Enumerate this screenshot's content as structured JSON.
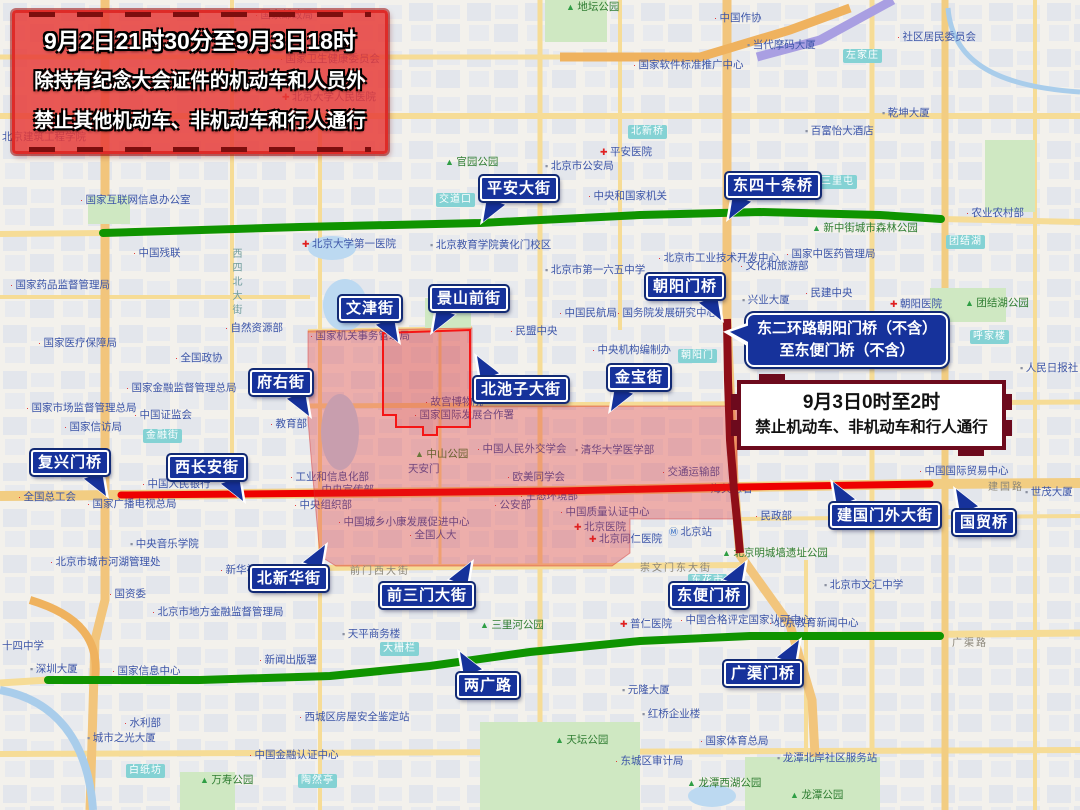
{
  "banners": {
    "top_left": {
      "line1": "9月2日21时30分至9月3日18时",
      "line2": "除持有纪念大会证件的机动车和人员外",
      "line3": "禁止其他机动车、非机动车和行人通行"
    },
    "east_ring": {
      "line1": "东二环路朝阳门桥（不含）",
      "line2": "至东便门桥（不含）"
    },
    "night_ban": {
      "line1": "9月3日0时至2时",
      "line2": "禁止机动车、非机动车和行人通行"
    }
  },
  "street_labels": [
    {
      "id": "pingan-dajie",
      "text": "平安大街",
      "x": 480,
      "y": 176,
      "tail": "bl"
    },
    {
      "id": "dongsishitiao-qiao",
      "text": "东四十条桥",
      "x": 726,
      "y": 173,
      "tail": "bl"
    },
    {
      "id": "wenjin-jie",
      "text": "文津街",
      "x": 339,
      "y": 296,
      "tail": "br"
    },
    {
      "id": "jingshanqian-jie",
      "text": "景山前街",
      "x": 430,
      "y": 286,
      "tail": "bl"
    },
    {
      "id": "chaoyangmen-qiao",
      "text": "朝阳门桥",
      "x": 646,
      "y": 274,
      "tail": "br"
    },
    {
      "id": "fuyou-jie",
      "text": "府右街",
      "x": 250,
      "y": 370,
      "tail": "br"
    },
    {
      "id": "beichizi-dajie",
      "text": "北池子大街",
      "x": 474,
      "y": 377,
      "tail": "tl"
    },
    {
      "id": "jinbao-jie",
      "text": "金宝街",
      "x": 608,
      "y": 365,
      "tail": "bl"
    },
    {
      "id": "fuxingmen-qiao",
      "text": "复兴门桥",
      "x": 31,
      "y": 450,
      "tail": "br"
    },
    {
      "id": "xichangan-jie",
      "text": "西长安街",
      "x": 168,
      "y": 455,
      "tail": "br"
    },
    {
      "id": "beixinhua-jie",
      "text": "北新华街",
      "x": 250,
      "y": 566,
      "tail": "tr"
    },
    {
      "id": "qiansanmen-dajie",
      "text": "前三门大街",
      "x": 380,
      "y": 583,
      "tail": "tr"
    },
    {
      "id": "dongbianmen-qiao",
      "text": "东便门桥",
      "x": 670,
      "y": 583,
      "tail": "tr"
    },
    {
      "id": "liangguang-lu",
      "text": "两广路",
      "x": 457,
      "y": 673,
      "tail": "tl"
    },
    {
      "id": "jianguomenwai-dajie",
      "text": "建国门外大街",
      "x": 830,
      "y": 503,
      "tail": "tl"
    },
    {
      "id": "guomao-qiao",
      "text": "国贸桥",
      "x": 953,
      "y": 510,
      "tail": "tl"
    },
    {
      "id": "guangqumen-qiao",
      "text": "广渠门桥",
      "x": 724,
      "y": 661,
      "tail": "tr"
    }
  ],
  "overlays": {
    "colors": {
      "restricted_green": "#0f9400",
      "restricted_red": "#ee0000",
      "restricted_maroon": "#8e0e18",
      "zone_fill": "rgba(224,40,40,0.33)",
      "label_navy": "#16329b"
    },
    "green_line_north": "103,233 300,227 480,223 640,215 760,212 880,215 941,219",
    "green_line_south": "48,680 200,680 330,676 430,666 530,652 640,641 750,636 940,636",
    "red_line": "121,495 350,493 560,491 740,487 930,484",
    "maroon_line": "727,319 728,380 730,440 734,490 737,520 740,553",
    "zone_polygon": "308,331 472,328 472,406 737,406 737,519 630,519 630,553 612,566 336,566 320,556 312,468 308,420",
    "inner_outline": "383,333 470,330 470,427 437,427 437,435 423,435 423,427 396,427 396,415 383,415"
  },
  "map": {
    "badges": [
      {
        "text": "交道口",
        "x": 436,
        "y": 193
      },
      {
        "text": "北新桥",
        "x": 628,
        "y": 125
      },
      {
        "text": "左家庄",
        "x": 843,
        "y": 49
      },
      {
        "text": "三里屯",
        "x": 818,
        "y": 175
      },
      {
        "text": "团结湖",
        "x": 946,
        "y": 235
      },
      {
        "text": "呼家楼",
        "x": 970,
        "y": 330
      },
      {
        "text": "朝阳门",
        "x": 678,
        "y": 349
      },
      {
        "text": "金融街",
        "x": 143,
        "y": 429
      },
      {
        "text": "大栅栏",
        "x": 380,
        "y": 642
      },
      {
        "text": "东花市",
        "x": 688,
        "y": 574
      },
      {
        "text": "白纸坊",
        "x": 126,
        "y": 764
      },
      {
        "text": "陶然亭",
        "x": 298,
        "y": 774
      }
    ],
    "street_names": [
      {
        "text": "西四北大街",
        "x": 228,
        "y": 248,
        "vert": true
      },
      {
        "text": "前门西大街",
        "x": 350,
        "y": 562,
        "vert": false
      },
      {
        "text": "崇文门东大街",
        "x": 640,
        "y": 559,
        "vert": false
      },
      {
        "text": "广渠路",
        "x": 952,
        "y": 634,
        "vert": false
      },
      {
        "text": "建国路",
        "x": 988,
        "y": 478,
        "vert": false
      }
    ],
    "pois": [
      {
        "t": "国家邮政局",
        "x": 255,
        "y": 18,
        "k": "dot"
      },
      {
        "t": "北京汉华国际饭店",
        "x": 228,
        "y": 48,
        "k": "bld"
      },
      {
        "t": "国家卫生健康委员会",
        "x": 280,
        "y": 62,
        "k": "dot"
      },
      {
        "t": "北京大学人民医院",
        "x": 282,
        "y": 100,
        "k": "hosp"
      },
      {
        "t": "社区居民委员会",
        "x": 897,
        "y": 40,
        "k": "dot"
      },
      {
        "t": "中国作协",
        "x": 714,
        "y": 21,
        "k": "dot"
      },
      {
        "t": "当代摩码大厦",
        "x": 747,
        "y": 48,
        "k": "bld"
      },
      {
        "t": "地坛公园",
        "x": 566,
        "y": 10,
        "k": "park"
      },
      {
        "t": "国家软件标准推广中心",
        "x": 633,
        "y": 68,
        "k": "dot"
      },
      {
        "t": "乾坤大厦",
        "x": 882,
        "y": 116,
        "k": "bld"
      },
      {
        "t": "百富怡大酒店",
        "x": 805,
        "y": 134,
        "k": "bld"
      },
      {
        "t": "北京建筑工程学院",
        "x": 2,
        "y": 140,
        "k": "none"
      },
      {
        "t": "官园公园",
        "x": 445,
        "y": 165,
        "k": "park"
      },
      {
        "t": "平安医院",
        "x": 600,
        "y": 155,
        "k": "hosp"
      },
      {
        "t": "中央和国家机关",
        "x": 588,
        "y": 199,
        "k": "dot"
      },
      {
        "t": "国家互联网信息办公室",
        "x": 80,
        "y": 203,
        "k": "dot"
      },
      {
        "t": "北京市公安局",
        "x": 545,
        "y": 169,
        "k": "bld"
      },
      {
        "t": "中国残联",
        "x": 133,
        "y": 256,
        "k": "dot"
      },
      {
        "t": "北京大学第一医院",
        "x": 302,
        "y": 247,
        "k": "hosp"
      },
      {
        "t": "国家药品监督管理局",
        "x": 10,
        "y": 288,
        "k": "dot"
      },
      {
        "t": "北京教育学院黄化门校区",
        "x": 430,
        "y": 248,
        "k": "bld"
      },
      {
        "t": "北京市第一六五中学",
        "x": 545,
        "y": 273,
        "k": "bld"
      },
      {
        "t": "北京市工业技术开发中心",
        "x": 658,
        "y": 261,
        "k": "dot"
      },
      {
        "t": "文化和旅游部",
        "x": 740,
        "y": 269,
        "k": "dot"
      },
      {
        "t": "国家中医药管理局",
        "x": 786,
        "y": 257,
        "k": "dot"
      },
      {
        "t": "新中街城市森林公园",
        "x": 812,
        "y": 231,
        "k": "park"
      },
      {
        "t": "农业农村部",
        "x": 966,
        "y": 216,
        "k": "dot"
      },
      {
        "t": "团结湖公园",
        "x": 965,
        "y": 306,
        "k": "park"
      },
      {
        "t": "朝阳医院",
        "x": 890,
        "y": 307,
        "k": "hosp"
      },
      {
        "t": "民建中央",
        "x": 805,
        "y": 296,
        "k": "dot"
      },
      {
        "t": "人民日报社",
        "x": 1020,
        "y": 371,
        "k": "bld"
      },
      {
        "t": "兴业大厦",
        "x": 742,
        "y": 303,
        "k": "bld"
      },
      {
        "t": "民盟中央",
        "x": 510,
        "y": 334,
        "k": "dot"
      },
      {
        "t": "中央机构编制办",
        "x": 592,
        "y": 353,
        "k": "dot"
      },
      {
        "t": "中国民航局",
        "x": 559,
        "y": 316,
        "k": "dot"
      },
      {
        "t": "国务院发展研究中心",
        "x": 617,
        "y": 316,
        "k": "dot"
      },
      {
        "t": "自然资源部",
        "x": 225,
        "y": 331,
        "k": "dot"
      },
      {
        "t": "全国政协",
        "x": 175,
        "y": 361,
        "k": "dot"
      },
      {
        "t": "国家金融监督管理总局",
        "x": 126,
        "y": 391,
        "k": "dot"
      },
      {
        "t": "中国证监会",
        "x": 134,
        "y": 418,
        "k": "dot"
      },
      {
        "t": "教育部",
        "x": 270,
        "y": 427,
        "k": "dot"
      },
      {
        "t": "国家机关事务管理局",
        "x": 310,
        "y": 339,
        "k": "dot"
      },
      {
        "t": "故宫博物院",
        "x": 425,
        "y": 405,
        "k": "dot"
      },
      {
        "t": "国家国际发展合作署",
        "x": 414,
        "y": 418,
        "k": "dot"
      },
      {
        "t": "中山公园",
        "x": 415,
        "y": 457,
        "k": "park"
      },
      {
        "t": "天安门",
        "x": 408,
        "y": 472,
        "k": "none"
      },
      {
        "t": "中国人民外交学会",
        "x": 477,
        "y": 452,
        "k": "dot"
      },
      {
        "t": "清华大学医学部",
        "x": 575,
        "y": 453,
        "k": "bld"
      },
      {
        "t": "交通运输部",
        "x": 662,
        "y": 475,
        "k": "dot"
      },
      {
        "t": "欧美同学会",
        "x": 507,
        "y": 480,
        "k": "dot"
      },
      {
        "t": "生态环境部",
        "x": 520,
        "y": 499,
        "k": "dot"
      },
      {
        "t": "公安部",
        "x": 494,
        "y": 508,
        "k": "dot"
      },
      {
        "t": "全国人大",
        "x": 409,
        "y": 538,
        "k": "dot"
      },
      {
        "t": "中国质量认证中心",
        "x": 560,
        "y": 515,
        "k": "dot"
      },
      {
        "t": "北京医院",
        "x": 574,
        "y": 530,
        "k": "hosp"
      },
      {
        "t": "北京同仁医院",
        "x": 589,
        "y": 542,
        "k": "hosp"
      },
      {
        "t": "北京站",
        "x": 669,
        "y": 535,
        "k": "metro"
      },
      {
        "t": "海关总署",
        "x": 705,
        "y": 492,
        "k": "dot"
      },
      {
        "t": "民政部",
        "x": 755,
        "y": 519,
        "k": "dot"
      },
      {
        "t": "中央宣传部",
        "x": 316,
        "y": 493,
        "k": "dot"
      },
      {
        "t": "中央组织部",
        "x": 294,
        "y": 508,
        "k": "dot"
      },
      {
        "t": "工业和信息化部",
        "x": 290,
        "y": 480,
        "k": "dot"
      },
      {
        "t": "中国城乡小康发展促进中心",
        "x": 338,
        "y": 525,
        "k": "dot"
      },
      {
        "t": "中国人民银行",
        "x": 142,
        "y": 487,
        "k": "dot"
      },
      {
        "t": "国家广播电视总局",
        "x": 87,
        "y": 507,
        "k": "dot"
      },
      {
        "t": "全国总工会",
        "x": 18,
        "y": 500,
        "k": "dot"
      },
      {
        "t": "国家市场监督管理总局",
        "x": 26,
        "y": 411,
        "k": "dot"
      },
      {
        "t": "国家医疗保障局",
        "x": 38,
        "y": 346,
        "k": "dot"
      },
      {
        "t": "国家信访局",
        "x": 64,
        "y": 430,
        "k": "dot"
      },
      {
        "t": "中央音乐学院",
        "x": 130,
        "y": 547,
        "k": "bld"
      },
      {
        "t": "北京市城市河湖管理处",
        "x": 50,
        "y": 565,
        "k": "dot"
      },
      {
        "t": "新华社",
        "x": 220,
        "y": 573,
        "k": "dot"
      },
      {
        "t": "国资委",
        "x": 109,
        "y": 597,
        "k": "dot"
      },
      {
        "t": "北京市地方金融监督管理局",
        "x": 152,
        "y": 615,
        "k": "dot"
      },
      {
        "t": "十四中学",
        "x": 2,
        "y": 649,
        "k": "none"
      },
      {
        "t": "深圳大厦",
        "x": 30,
        "y": 672,
        "k": "bld"
      },
      {
        "t": "国家信息中心",
        "x": 112,
        "y": 674,
        "k": "dot"
      },
      {
        "t": "新闻出版署",
        "x": 259,
        "y": 663,
        "k": "dot"
      },
      {
        "t": "水利部",
        "x": 124,
        "y": 726,
        "k": "dot"
      },
      {
        "t": "城市之光大厦",
        "x": 87,
        "y": 741,
        "k": "bld"
      },
      {
        "t": "西城区房屋安全鉴定站",
        "x": 299,
        "y": 720,
        "k": "dot"
      },
      {
        "t": "中国金融认证中心",
        "x": 249,
        "y": 758,
        "k": "dot"
      },
      {
        "t": "万寿公园",
        "x": 200,
        "y": 783,
        "k": "park"
      },
      {
        "t": "天平商务楼",
        "x": 342,
        "y": 637,
        "k": "bld"
      },
      {
        "t": "三里河公园",
        "x": 480,
        "y": 628,
        "k": "park"
      },
      {
        "t": "普仁医院",
        "x": 620,
        "y": 627,
        "k": "hosp"
      },
      {
        "t": "中国合格评定国家认可中心",
        "x": 680,
        "y": 623,
        "k": "dot"
      },
      {
        "t": "元隆大厦",
        "x": 622,
        "y": 693,
        "k": "bld"
      },
      {
        "t": "北京市文汇中学",
        "x": 824,
        "y": 588,
        "k": "bld"
      },
      {
        "t": "北京教育新闻中心",
        "x": 769,
        "y": 626,
        "k": "dot"
      },
      {
        "t": "北京明城墙遗址公园",
        "x": 722,
        "y": 556,
        "k": "park"
      },
      {
        "t": "中国国际贸易中心",
        "x": 919,
        "y": 474,
        "k": "dot"
      },
      {
        "t": "世茂大厦",
        "x": 1025,
        "y": 495,
        "k": "bld"
      },
      {
        "t": "红桥企业楼",
        "x": 642,
        "y": 717,
        "k": "bld"
      },
      {
        "t": "国家体育总局",
        "x": 700,
        "y": 744,
        "k": "dot"
      },
      {
        "t": "东城区审计局",
        "x": 615,
        "y": 764,
        "k": "dot"
      },
      {
        "t": "龙潭北岸社区服务站",
        "x": 777,
        "y": 761,
        "k": "bld"
      },
      {
        "t": "龙潭西湖公园",
        "x": 687,
        "y": 786,
        "k": "park"
      },
      {
        "t": "龙潭公园",
        "x": 790,
        "y": 798,
        "k": "park"
      },
      {
        "t": "天坛公园",
        "x": 555,
        "y": 743,
        "k": "park"
      }
    ]
  }
}
